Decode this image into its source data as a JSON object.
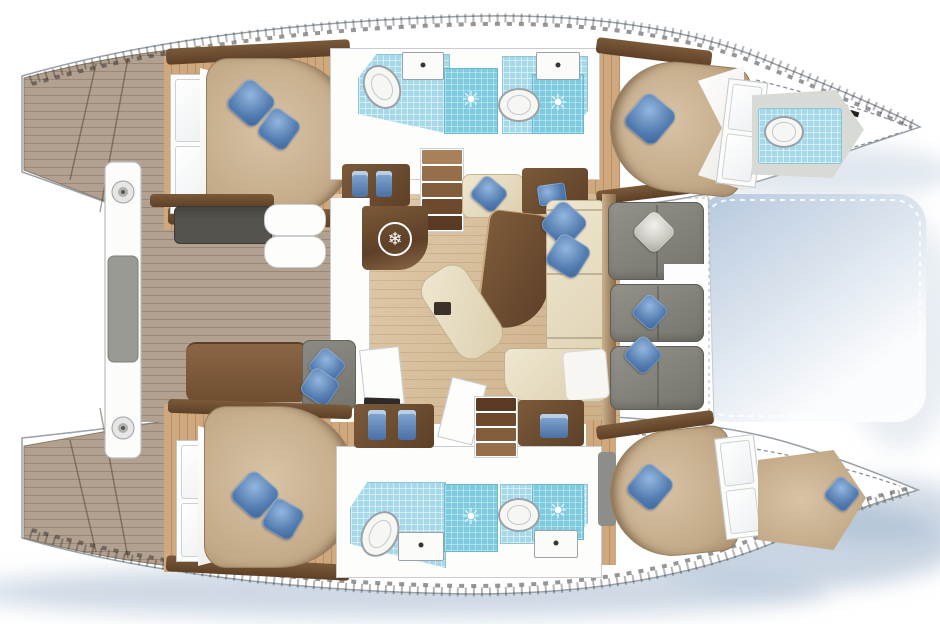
{
  "meta": {
    "type": "floorplan",
    "subject": "catamaran-yacht-accommodation-and-deck-plan",
    "view": "top-down",
    "cabins": 4,
    "bathrooms": 4,
    "forepeak_head": 1,
    "forepeak_berth": 1,
    "cockpits": 2
  },
  "symbols": {
    "fridge_snowflake": "❄",
    "shower_drain_sun": "☀"
  },
  "colors": {
    "hull-outline": "#99a1a9",
    "deck-wood": "#b2a090",
    "deck-line": "#9a8875",
    "cabin-floor": "#cfa87d",
    "cabin-floor-line": "#b98f63",
    "salon-floor": "#d6b88e",
    "wood-dark": "#5d4027",
    "wood-mid": "#7b5a3a",
    "mattress": "#c2a988",
    "mattress-hi": "#d8c3a5",
    "mattress-lo": "#a98f6e",
    "duvet": "#f4f2ec",
    "pillow": "#537cb0",
    "pillow-hi": "#93b6de",
    "pillow-lo": "#3c6296",
    "tile": "#a5d9ea",
    "shower": "#7ecbdf",
    "fixture-line": "#9ba2a7",
    "wall-line": "#c9cdd1",
    "sofa-gray": "#85847c",
    "sofa-gray-dark": "#5e5d57",
    "bench-dark": "#54534d",
    "lounge-gray": "#83827b",
    "bench-brown": "#7c5936",
    "cream": "#e7dcc0",
    "tramp-1": "#b6c8de",
    "tramp-2": "#fbfcfe",
    "shadow": "#9db3cb",
    "arrow-red": "#a81d14",
    "pad-gray": "#9a9a94",
    "forepeak-floor": "#d8dad6"
  }
}
